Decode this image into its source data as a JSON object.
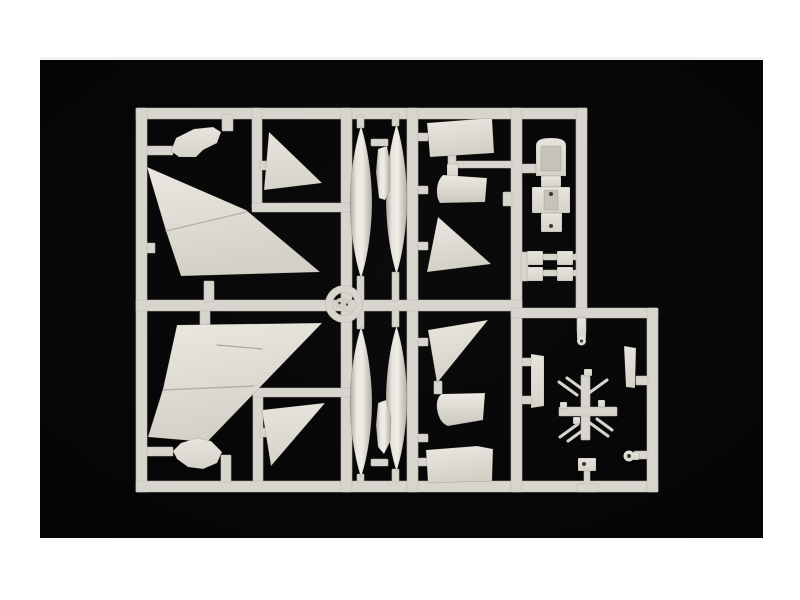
{
  "page": {
    "background": "#ffffff"
  },
  "photo": {
    "x": 40,
    "y": 57,
    "width": 723,
    "height": 478,
    "background_center": "#0b0b0b",
    "background_edge": "#050505",
    "description": "black studio background of product photo"
  },
  "palette": {
    "runner": "#d7d5cd",
    "runner_edge": "#bdbbb2",
    "part_base": "#e0ded6",
    "part_inner_shadow": "#c6c3b9",
    "seam": "#b3b1a8",
    "crease": "#a9a79e",
    "blob": "#cfcdc4",
    "dot": "#3a382f",
    "speck": "#4a483f"
  },
  "sprue": {
    "description": "light grey plastic model-kit sprue frame with aircraft parts: two large delta wing halves, two tail fins, four drop tanks, intake and fuselage panels, cockpit tub, small equipment squares, landing gear and antenna parts, circular center ring",
    "runners": [
      {
        "name": "frame-top",
        "x": 136,
        "y": 108,
        "w": 451,
        "h": 11
      },
      {
        "name": "frame-left",
        "x": 136,
        "y": 108,
        "w": 11,
        "h": 384
      },
      {
        "name": "frame-bottom",
        "x": 136,
        "y": 481,
        "w": 522,
        "h": 11
      },
      {
        "name": "divider-mid-vertical",
        "x": 341,
        "y": 108,
        "w": 11,
        "h": 384
      },
      {
        "name": "divider-tanks-right",
        "x": 407,
        "y": 108,
        "w": 11,
        "h": 384
      },
      {
        "name": "divider-intake-right",
        "x": 511,
        "y": 108,
        "w": 11,
        "h": 384
      },
      {
        "name": "cell-topright-right",
        "x": 576,
        "y": 108,
        "w": 11,
        "h": 205
      },
      {
        "name": "mid-horizontal",
        "x": 136,
        "y": 300,
        "w": 386,
        "h": 11
      },
      {
        "name": "cell-bottomright-top",
        "x": 511,
        "y": 308,
        "w": 147,
        "h": 10
      },
      {
        "name": "cell-bottomright-right",
        "x": 647,
        "y": 308,
        "w": 11,
        "h": 184
      },
      {
        "name": "sub-topleft-vertical",
        "x": 252,
        "y": 108,
        "w": 10,
        "h": 100
      },
      {
        "name": "sub-topleft-horizontal",
        "x": 252,
        "y": 203,
        "w": 99,
        "h": 9
      },
      {
        "name": "stub-fairing-top",
        "x": 222,
        "y": 114,
        "w": 11,
        "h": 17
      },
      {
        "name": "bar-fairing-left-top",
        "x": 147,
        "y": 146,
        "w": 26,
        "h": 9
      },
      {
        "name": "nub-left-top",
        "x": 147,
        "y": 243,
        "w": 8,
        "h": 10
      },
      {
        "name": "tab-wing-top",
        "x": 204,
        "y": 281,
        "w": 10,
        "h": 21
      },
      {
        "name": "tab-fin-top",
        "x": 260,
        "y": 161,
        "w": 7,
        "h": 9
      },
      {
        "name": "sub-bottomleft-vertical",
        "x": 253,
        "y": 392,
        "w": 10,
        "h": 89
      },
      {
        "name": "sub-bottomleft-horizontal",
        "x": 253,
        "y": 388,
        "w": 98,
        "h": 9
      },
      {
        "name": "tab-wing-bottom",
        "x": 200,
        "y": 311,
        "w": 10,
        "h": 16
      },
      {
        "name": "bar-fairing-left-bottom",
        "x": 147,
        "y": 447,
        "w": 26,
        "h": 9
      },
      {
        "name": "bar-fairing-elbow-bottom",
        "x": 221,
        "y": 455,
        "w": 10,
        "h": 27
      },
      {
        "name": "tab-fin-bottom",
        "x": 260,
        "y": 428,
        "w": 7,
        "h": 9
      },
      {
        "name": "stub-tank1-top",
        "x": 357,
        "y": 115,
        "w": 7,
        "h": 13
      },
      {
        "name": "stub-tank2-top",
        "x": 392,
        "y": 113,
        "w": 7,
        "h": 13
      },
      {
        "name": "bar-tanks-top",
        "x": 371,
        "y": 139,
        "w": 17,
        "h": 7
      },
      {
        "name": "stub-tank1-bottom",
        "x": 357,
        "y": 276,
        "w": 7,
        "h": 25
      },
      {
        "name": "stub-tank2-bottom",
        "x": 392,
        "y": 272,
        "w": 7,
        "h": 29
      },
      {
        "name": "stub-tank3-top",
        "x": 357,
        "y": 310,
        "w": 7,
        "h": 19
      },
      {
        "name": "stub-tank4-top",
        "x": 392,
        "y": 310,
        "w": 7,
        "h": 17
      },
      {
        "name": "bar-tanks-bottom",
        "x": 371,
        "y": 459,
        "w": 17,
        "h": 7
      },
      {
        "name": "stub-tank3-bottom",
        "x": 357,
        "y": 474,
        "w": 7,
        "h": 8
      },
      {
        "name": "stub-tank4-bottom",
        "x": 392,
        "y": 469,
        "w": 7,
        "h": 13
      },
      {
        "name": "stub-panel-top",
        "x": 418,
        "y": 133,
        "w": 10,
        "h": 8
      },
      {
        "name": "bar-bracket-top",
        "x": 456,
        "y": 161,
        "w": 56,
        "h": 7
      },
      {
        "name": "stub-panel-bracket",
        "x": 448,
        "y": 155,
        "w": 8,
        "h": 11
      },
      {
        "name": "stub-cowling-top",
        "x": 418,
        "y": 186,
        "w": 10,
        "h": 8
      },
      {
        "name": "tab-tri-topright",
        "x": 418,
        "y": 242,
        "w": 10,
        "h": 8
      },
      {
        "name": "tab-tri-bottomright",
        "x": 418,
        "y": 338,
        "w": 10,
        "h": 8
      },
      {
        "name": "stub-cowling-bottom",
        "x": 418,
        "y": 434,
        "w": 10,
        "h": 8
      },
      {
        "name": "stub-panel-bottom",
        "x": 418,
        "y": 458,
        "w": 10,
        "h": 8
      },
      {
        "name": "stub-tri-cowl-bottom",
        "x": 434,
        "y": 381,
        "w": 8,
        "h": 13
      },
      {
        "name": "bar-cockpit",
        "x": 522,
        "y": 164,
        "w": 14,
        "h": 9
      },
      {
        "name": "nub-intake-right",
        "x": 503,
        "y": 192,
        "w": 9,
        "h": 14
      },
      {
        "name": "bar-squares-left",
        "x": 521,
        "y": 252,
        "w": 7,
        "h": 29
      },
      {
        "name": "bar-squares-mid-1",
        "x": 543,
        "y": 254,
        "w": 14,
        "h": 6
      },
      {
        "name": "bar-squares-mid-2",
        "x": 543,
        "y": 270,
        "w": 14,
        "h": 6
      },
      {
        "name": "bar-squares-right-1",
        "x": 573,
        "y": 254,
        "w": 4,
        "h": 6
      },
      {
        "name": "bar-squares-right-2",
        "x": 573,
        "y": 270,
        "w": 4,
        "h": 6
      },
      {
        "name": "stub-gearleg",
        "x": 577,
        "y": 317,
        "w": 9,
        "h": 16
      },
      {
        "name": "bar-pylon-1",
        "x": 522,
        "y": 358,
        "w": 10,
        "h": 8
      },
      {
        "name": "bar-pylon-2",
        "x": 522,
        "y": 396,
        "w": 10,
        "h": 8
      },
      {
        "name": "bar-strut",
        "x": 636,
        "y": 376,
        "w": 12,
        "h": 9
      },
      {
        "name": "cross-vertical",
        "x": 581,
        "y": 375,
        "w": 9,
        "h": 65
      },
      {
        "name": "cross-horizontal",
        "x": 559,
        "y": 407,
        "w": 58,
        "h": 9
      },
      {
        "name": "bar-wheel",
        "x": 634,
        "y": 451,
        "w": 14,
        "h": 8
      },
      {
        "name": "stem-nosegear",
        "x": 584,
        "y": 470,
        "w": 6,
        "h": 15
      },
      {
        "name": "foot-nosegear",
        "x": 577,
        "y": 484,
        "w": 21,
        "h": 8
      }
    ],
    "ring": {
      "cx": 344,
      "cy": 304,
      "r_mid": 15,
      "thickness": 7
    },
    "parts": [
      {
        "name": "part-wingtip-fairing-upper",
        "type": "polygon",
        "points": "171,151 176,138 194,129 213,127 221,132 217,143 203,150 196,157 179,157",
        "fill": "gPart"
      },
      {
        "name": "part-main-wing-upper",
        "type": "polygon",
        "points": "147,167 246,210 320,272 181,276 166,231",
        "fill": "gWing"
      },
      {
        "name": "part-main-wing-upper-seam",
        "type": "line",
        "x1": 166,
        "y1": 231,
        "x2": 246,
        "y2": 212,
        "stroke": "#b3b1a8",
        "width": 1.4
      },
      {
        "name": "part-tailfin-upper",
        "type": "polygon",
        "points": "269,132 322,183 264,190",
        "fill": "gPart"
      },
      {
        "name": "part-droptank-1",
        "type": "lens",
        "cx": 361,
        "y1": 126,
        "y2": 278,
        "hw": 11,
        "fill": "gTank"
      },
      {
        "name": "part-droptank-2",
        "type": "lens",
        "cx": 396.5,
        "y1": 124,
        "y2": 274,
        "hw": 10.5,
        "fill": "gTank"
      },
      {
        "name": "part-tank-pylon-upper",
        "type": "polygon",
        "points": "378,149 387,146 390,162 390,190 385,200 379,198 376,172",
        "fill": "gTank"
      },
      {
        "name": "part-fuselage-panel-upper",
        "type": "polygon",
        "points": "427,123 492,118 494,153 430,157",
        "fill": "gWing"
      },
      {
        "name": "part-bracket-upper",
        "type": "rect",
        "x": 447,
        "y": 164,
        "w": 11,
        "h": 13,
        "fill": "gPart"
      },
      {
        "name": "part-intake-cowl-upper",
        "type": "path",
        "d": "M443,175 L487,178 L485,202 L440,203 C435,196 436,181 443,175 Z",
        "fill": "gCowl"
      },
      {
        "name": "part-wing-triangle-upper",
        "type": "polygon",
        "points": "438,217 491,264 427,272",
        "fill": "gWing"
      },
      {
        "name": "part-cockpit-tub-top",
        "type": "path",
        "d": "M536,146 C536,140 541,138 551,138 C561,138 566,140 566,146 L566,176 L536,176 Z",
        "fill": "gPart"
      },
      {
        "name": "part-cockpit-tub-inner-top",
        "type": "rect",
        "x": 541,
        "y": 146,
        "w": 20,
        "h": 25,
        "fill": "#c6c3b9"
      },
      {
        "name": "part-cockpit-waist",
        "type": "rect",
        "x": 541,
        "y": 176,
        "w": 20,
        "h": 11,
        "fill": "gPart"
      },
      {
        "name": "part-cockpit-mid",
        "type": "rect",
        "x": 532,
        "y": 187,
        "w": 38,
        "h": 26,
        "fill": "gPart"
      },
      {
        "name": "part-cockpit-inner-mid",
        "type": "rect",
        "x": 544,
        "y": 190,
        "w": 14,
        "h": 20,
        "fill": "#c6c3b9"
      },
      {
        "name": "part-cockpit-tail",
        "type": "rect",
        "x": 541,
        "y": 213,
        "w": 21,
        "h": 19,
        "fill": "gPart"
      },
      {
        "name": "part-cockpit-dot-1",
        "type": "circle",
        "cx": 551,
        "cy": 194,
        "r": 2,
        "fill": "#3a382f"
      },
      {
        "name": "part-cockpit-dot-2",
        "type": "circle",
        "cx": 551,
        "cy": 226,
        "r": 2,
        "fill": "#3a382f"
      },
      {
        "name": "part-equipment-square-1",
        "type": "rect",
        "x": 527,
        "y": 251,
        "w": 16,
        "h": 14,
        "fill": "gPart"
      },
      {
        "name": "part-equipment-square-2",
        "type": "rect",
        "x": 527,
        "y": 267,
        "w": 16,
        "h": 14,
        "fill": "gPart"
      },
      {
        "name": "part-equipment-square-3",
        "type": "rect",
        "x": 557,
        "y": 251,
        "w": 16,
        "h": 14,
        "fill": "gPart"
      },
      {
        "name": "part-equipment-square-4",
        "type": "rect",
        "x": 557,
        "y": 267,
        "w": 16,
        "h": 14,
        "fill": "gPart"
      },
      {
        "name": "part-main-wing-lower",
        "type": "polygon",
        "points": "177,325 322,323 207,442 148,437 163,389",
        "fill": "gWing"
      },
      {
        "name": "part-main-wing-lower-seam",
        "type": "line",
        "x1": 163,
        "y1": 390,
        "x2": 254,
        "y2": 386,
        "stroke": "#b3b1a8",
        "width": 1.4
      },
      {
        "name": "part-main-wing-lower-crease",
        "type": "line",
        "x1": 217,
        "y1": 345,
        "x2": 262,
        "y2": 349,
        "stroke": "#a9a79e",
        "width": 1.2
      },
      {
        "name": "part-wingtip-fairing-lower",
        "type": "polygon",
        "points": "173,451 181,443 197,438 211,441 222,452 217,463 203,469 188,467 177,459",
        "fill": "gPart"
      },
      {
        "name": "part-tailfin-lower",
        "type": "polygon",
        "points": "262,410 325,403 271,466",
        "fill": "gPart"
      },
      {
        "name": "part-droptank-3",
        "type": "lens",
        "cx": 361,
        "y1": 327,
        "y2": 477,
        "hw": 11,
        "fill": "gTank"
      },
      {
        "name": "part-droptank-4",
        "type": "lens",
        "cx": 396.5,
        "y1": 326,
        "y2": 471,
        "hw": 10.5,
        "fill": "gTank"
      },
      {
        "name": "part-tank-pylon-lower",
        "type": "polygon",
        "points": "378,403 386,400 391,418 390,442 384,454 378,447 376,425",
        "fill": "gTank"
      },
      {
        "name": "part-wing-triangle-lower",
        "type": "polygon",
        "points": "428,330 488,320 437,383",
        "fill": "gWing"
      },
      {
        "name": "part-intake-cowl-lower",
        "type": "path",
        "d": "M442,394 L485,393 L483,420 L448,426 C439,423 436,410 437,402 C438,397 440,395 442,394 Z",
        "fill": "gCowl"
      },
      {
        "name": "part-fuselage-panel-lower",
        "type": "polygon",
        "points": "426,450 477,446 493,449 492,481 428,483",
        "fill": "gWing"
      },
      {
        "name": "part-store-pylon",
        "type": "polygon",
        "points": "531,354 544,356 544,406 531,408",
        "fill": "gPart"
      },
      {
        "name": "part-gear-leg",
        "type": "rect",
        "x": 577,
        "y": 318,
        "w": 9,
        "h": 21,
        "fill": "gPart"
      },
      {
        "name": "part-gear-leg-wheel",
        "type": "circle",
        "cx": 581.5,
        "cy": 341,
        "r": 4.5,
        "fill": "gPart"
      },
      {
        "name": "part-gear-leg-hub",
        "type": "circle",
        "cx": 581.5,
        "cy": 341,
        "r": 1.5,
        "fill": "#3a382f"
      },
      {
        "name": "part-gear-strut",
        "type": "polygon",
        "points": "624,346 636,348 635,388 626,387",
        "fill": "gPart"
      },
      {
        "name": "part-antenna-1",
        "type": "line",
        "x1": 559,
        "y1": 382,
        "x2": 577,
        "y2": 395,
        "stroke": "#d7d5cd",
        "width": 3
      },
      {
        "name": "part-antenna-2",
        "type": "line",
        "x1": 567,
        "y1": 378,
        "x2": 585,
        "y2": 391,
        "stroke": "#d7d5cd",
        "width": 3
      },
      {
        "name": "part-antenna-3",
        "type": "line",
        "x1": 589,
        "y1": 393,
        "x2": 607,
        "y2": 380,
        "stroke": "#d7d5cd",
        "width": 3
      },
      {
        "name": "part-antenna-4",
        "type": "line",
        "x1": 560,
        "y1": 437,
        "x2": 578,
        "y2": 424,
        "stroke": "#d7d5cd",
        "width": 3
      },
      {
        "name": "part-antenna-5",
        "type": "line",
        "x1": 568,
        "y1": 441,
        "x2": 586,
        "y2": 428,
        "stroke": "#d7d5cd",
        "width": 3
      },
      {
        "name": "part-antenna-6",
        "type": "line",
        "x1": 590,
        "y1": 423,
        "x2": 608,
        "y2": 436,
        "stroke": "#d7d5cd",
        "width": 3
      },
      {
        "name": "part-antenna-7",
        "type": "line",
        "x1": 597,
        "y1": 419,
        "x2": 612,
        "y2": 430,
        "stroke": "#d7d5cd",
        "width": 3
      },
      {
        "name": "part-cross-nub-1",
        "type": "rect",
        "x": 584,
        "y": 369,
        "w": 8,
        "h": 7,
        "fill": "gPart"
      },
      {
        "name": "part-cross-nub-2",
        "type": "rect",
        "x": 560,
        "y": 402,
        "w": 7,
        "h": 7,
        "fill": "gPart"
      },
      {
        "name": "part-cross-nub-3",
        "type": "rect",
        "x": 598,
        "y": 400,
        "w": 7,
        "h": 7,
        "fill": "gPart"
      },
      {
        "name": "part-cross-nub-4",
        "type": "rect",
        "x": 573,
        "y": 417,
        "w": 7,
        "h": 7,
        "fill": "gPart"
      },
      {
        "name": "part-wheel-axle",
        "type": "rect",
        "x": 633,
        "y": 452,
        "w": 6,
        "h": 8,
        "fill": "gPart"
      },
      {
        "name": "part-wheel",
        "type": "circle",
        "cx": 629,
        "cy": 456,
        "r": 5.5,
        "fill": "gPart"
      },
      {
        "name": "part-wheel-hub",
        "type": "circle",
        "cx": 629,
        "cy": 456,
        "r": 2,
        "fill": "#3a382f"
      },
      {
        "name": "part-nose-gear-bracket",
        "type": "rect",
        "x": 578,
        "y": 458,
        "w": 18,
        "h": 13,
        "fill": "gPart"
      },
      {
        "name": "part-nose-gear-dot",
        "type": "circle",
        "cx": 584,
        "cy": 464,
        "r": 2,
        "fill": "#3a382f"
      },
      {
        "name": "part-ring-blob",
        "type": "ellipse",
        "cx": 343,
        "cy": 303,
        "rx": 8,
        "ry": 5.5,
        "fill": "#cfcdc4"
      },
      {
        "name": "part-ring-speck-1",
        "type": "circle",
        "cx": 339.5,
        "cy": 303,
        "r": 1.3,
        "fill": "#4a483f"
      },
      {
        "name": "part-ring-speck-2",
        "type": "circle",
        "cx": 347,
        "cy": 304.5,
        "r": 1.1,
        "fill": "#4a483f"
      }
    ]
  }
}
